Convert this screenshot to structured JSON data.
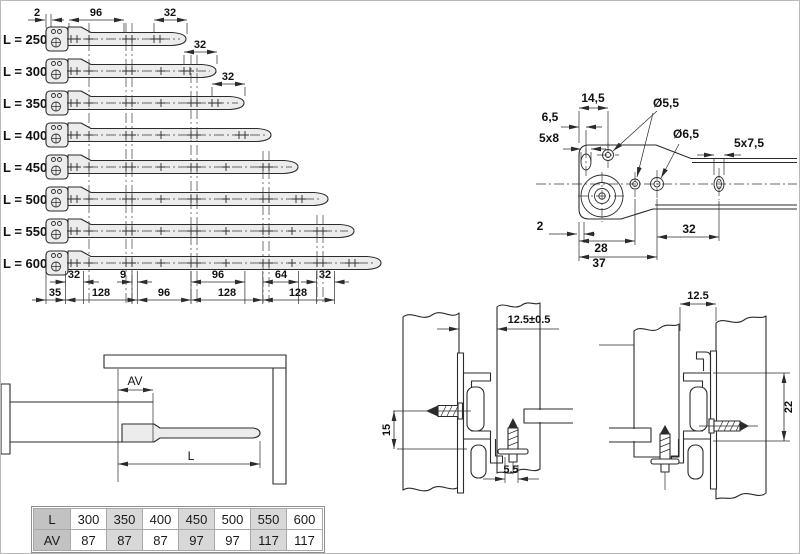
{
  "colors": {
    "line": "#2b2b2b",
    "rail_fill": "#ececec",
    "table_header_bg": "#c2c2c2",
    "table_shade_bg": "#d8d8d8"
  },
  "slides": {
    "rows": [
      "L = 250",
      "L = 300",
      "L = 350",
      "L = 400",
      "L = 450",
      "L = 500",
      "L = 550",
      "L = 600"
    ],
    "top_dims": {
      "offset": "2",
      "pitch": "96",
      "end_spacing": "32"
    },
    "callouts": [
      "32",
      "32"
    ],
    "bottom_row1": [
      "32",
      "9",
      "96",
      "64",
      "32"
    ],
    "bottom_row2": [
      "35",
      "128",
      "96",
      "128",
      "128"
    ]
  },
  "end_detail": {
    "dims": {
      "d14_5": "14,5",
      "d6_5": "6,5",
      "slot_front": "5x8",
      "dia_small": "Ø5,5",
      "dia_large": "Ø6,5",
      "slot_rear": "5x7,5",
      "d2": "2",
      "d28": "28",
      "d32": "32",
      "d37": "37"
    }
  },
  "side_view": {
    "av": "AV",
    "l": "L"
  },
  "mount_detail_left": {
    "gap": "12.5±0.5",
    "height": "15",
    "offset": "5.5"
  },
  "mount_detail_right": {
    "gap": "12.5",
    "height": "22"
  },
  "table": {
    "rows": [
      {
        "header": "L",
        "values": [
          "300",
          "350",
          "400",
          "450",
          "500",
          "550",
          "600"
        ]
      },
      {
        "header": "AV",
        "values": [
          "87",
          "87",
          "87",
          "97",
          "97",
          "117",
          "117"
        ]
      }
    ]
  }
}
